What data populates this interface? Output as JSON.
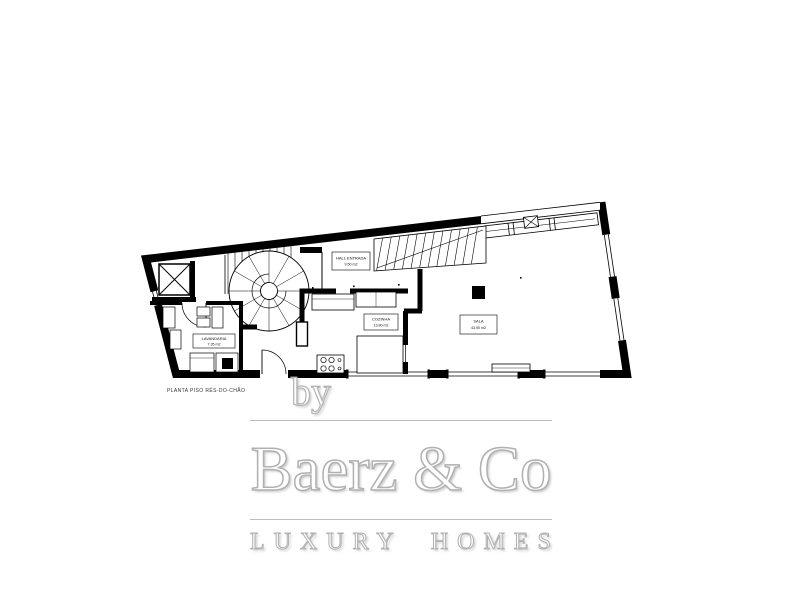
{
  "plan": {
    "caption": "PLANTA PISO RÉS-DO-CHÃO",
    "rooms": [
      {
        "name": "HALL ENTRADA",
        "area": "9.50 m2"
      },
      {
        "name": "COZINHA",
        "area": "13.80 m2"
      },
      {
        "name": "SALA",
        "area": "43.90 m2"
      },
      {
        "name": "LAVANDARIA",
        "area": "7.35 m2"
      }
    ]
  },
  "watermark": {
    "by": "by",
    "brand": "Baerz & Co",
    "tagline": "LUXURY HOMES"
  },
  "colors": {
    "walls": "#000000",
    "background": "#ffffff",
    "watermark_gray": "#b3b3b3"
  }
}
